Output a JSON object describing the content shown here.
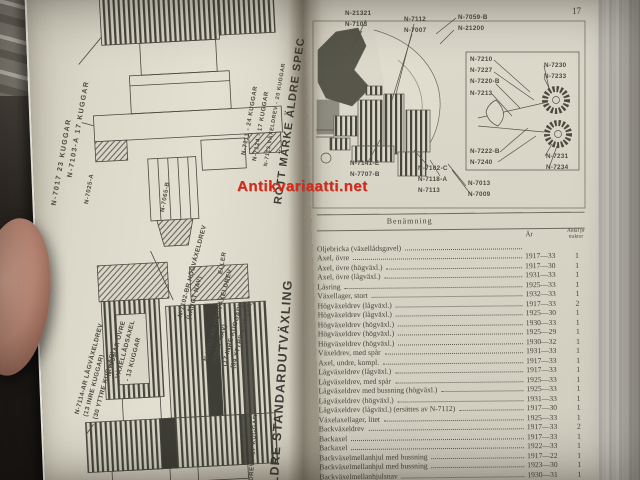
{
  "photo": {
    "watermark_text": "Antikvariaatti.net",
    "watermark_color": "#d62b1c"
  },
  "book": {
    "page_number": "17"
  },
  "left_page": {
    "labels": {
      "gear_top_1": "N-7017 23 KUGGAR",
      "gear_top_2": "N-7103-A 17 KUGGAR",
      "bearing": "N-7025-A",
      "part_7065": "N-7065-B",
      "gear_7111": "N-7111 - 24 KUGGAR",
      "gear_7124": "N-7124 - 17 KUGGAR",
      "gear_7113": "N-7113 VÄXELDREV - 20 KUGGAR",
      "headline_top": "RÖTT MÄRKE ÄLDRE SPEC",
      "lowgear_group": "N-7114-AR LÅGVÄXELDREV\n(13 INRE KUGGAR)\n(30 YTTRE KUGGAR)",
      "shaft_group": "N-7059-AR ÖVRE\nVÄXELLÅDSAXEL\n- 13 KUGGAR",
      "highgear_long": "N-7102-BR HÖGVÄXELDREV\n(LÅNGT NAV)",
      "eller": "ELLER",
      "highgear_short": "N-7102-AR HÖGVÄXELDREV\n(KORT NAV)\n(17 INRE KUGGAR)\n(34 YTTRE KUGGAR)",
      "headline_bottom": "ÄLDRE STANDARDUTVÄXLING",
      "gear_bottom_edge": "ELDREV - 17 KUGGAR"
    }
  },
  "right_page": {
    "diagram_labels": {
      "top_left": "N-21321\nN-7103",
      "top_mid": "N-7112\nN-7007",
      "top_right": "N-7059-B\nN-21200",
      "inset_top_left": "N-7210\nN-7227\nN-7220-B\nN-7213",
      "inset_top_right": "N-7230\nN-7233",
      "inset_bottom_left": "N-7222-B\nN-7240",
      "inset_bottom_right": "N-7231\nN-7234",
      "bottom_left": "N-7141-E\nN-7707-B",
      "bottom_mid": "N-7102-C\nN-7118-A\nN-7113",
      "bottom_right": "N-7013\nN-7009"
    },
    "table": {
      "col_benamning": "Benämning",
      "col_ar": "År",
      "col_antal": "Antal pr\ntraktor",
      "rows": [
        {
          "name": "Oljebricka (växellådsgavel)",
          "year": "",
          "qty": ""
        },
        {
          "name": "Axel, övre",
          "year": "1917—33",
          "qty": "1"
        },
        {
          "name": "Axel, övre (högväxl.)",
          "year": "1917—30",
          "qty": "1"
        },
        {
          "name": "Axel, övre (lågväxl.)",
          "year": "1931—33",
          "qty": "1"
        },
        {
          "name": "Låsring",
          "year": "1925—33",
          "qty": "1"
        },
        {
          "name": "Växellager, stort",
          "year": "1932—33",
          "qty": "1"
        },
        {
          "name": "Högväxeldrev (lågväxl.)",
          "year": "1917—33",
          "qty": "2"
        },
        {
          "name": "Högväxeldrev (lågväxl.)",
          "year": "1925—30",
          "qty": "1"
        },
        {
          "name": "Högväxeldrev (högväxl.)",
          "year": "1930—33",
          "qty": "1"
        },
        {
          "name": "Högväxeldrev (högväxl.)",
          "year": "1925—29",
          "qty": "1"
        },
        {
          "name": "Högväxeldrev (högväxl.)",
          "year": "1930—32",
          "qty": "1"
        },
        {
          "name": "Växeldrev, med spår",
          "year": "1931—33",
          "qty": "1"
        },
        {
          "name": "Axel, undre, kompl.",
          "year": "1917—33",
          "qty": "1"
        },
        {
          "name": "Lågväxeldrev (lågväxl.)",
          "year": "1917—33",
          "qty": "1"
        },
        {
          "name": "Lågväxeldrev, med spår",
          "year": "1925—33",
          "qty": "1"
        },
        {
          "name": "Lågväxeldrev med bussning (högväxl.)",
          "year": "1925—33",
          "qty": "1"
        },
        {
          "name": "Lågväxeldrev (högväxl.)",
          "year": "1931—33",
          "qty": "1"
        },
        {
          "name": "Lågväxeldrev (lågväxl.) (ersättes av N-7112)",
          "year": "1917—30",
          "qty": "1"
        },
        {
          "name": "Växelaxellager, litet",
          "year": "1925—33",
          "qty": "1"
        },
        {
          "name": "Backväxeldrev",
          "year": "1917—33",
          "qty": "2"
        },
        {
          "name": "Backaxel",
          "year": "1917—33",
          "qty": "1"
        },
        {
          "name": "Backaxel",
          "year": "1922—33",
          "qty": "1"
        },
        {
          "name": "Backväxelmellanhjul med bussning",
          "year": "1917—22",
          "qty": "1"
        },
        {
          "name": "Backväxelmellanhjul med bussning",
          "year": "1923—30",
          "qty": "1"
        },
        {
          "name": "Backväxelmellanhjulsnav",
          "year": "1930—31",
          "qty": "1"
        },
        {
          "name": "Backaxelbussning",
          "year": "1931—33",
          "qty": "1"
        },
        {
          "name": "",
          "year": "1924—30",
          "qty": "1"
        }
      ]
    }
  }
}
